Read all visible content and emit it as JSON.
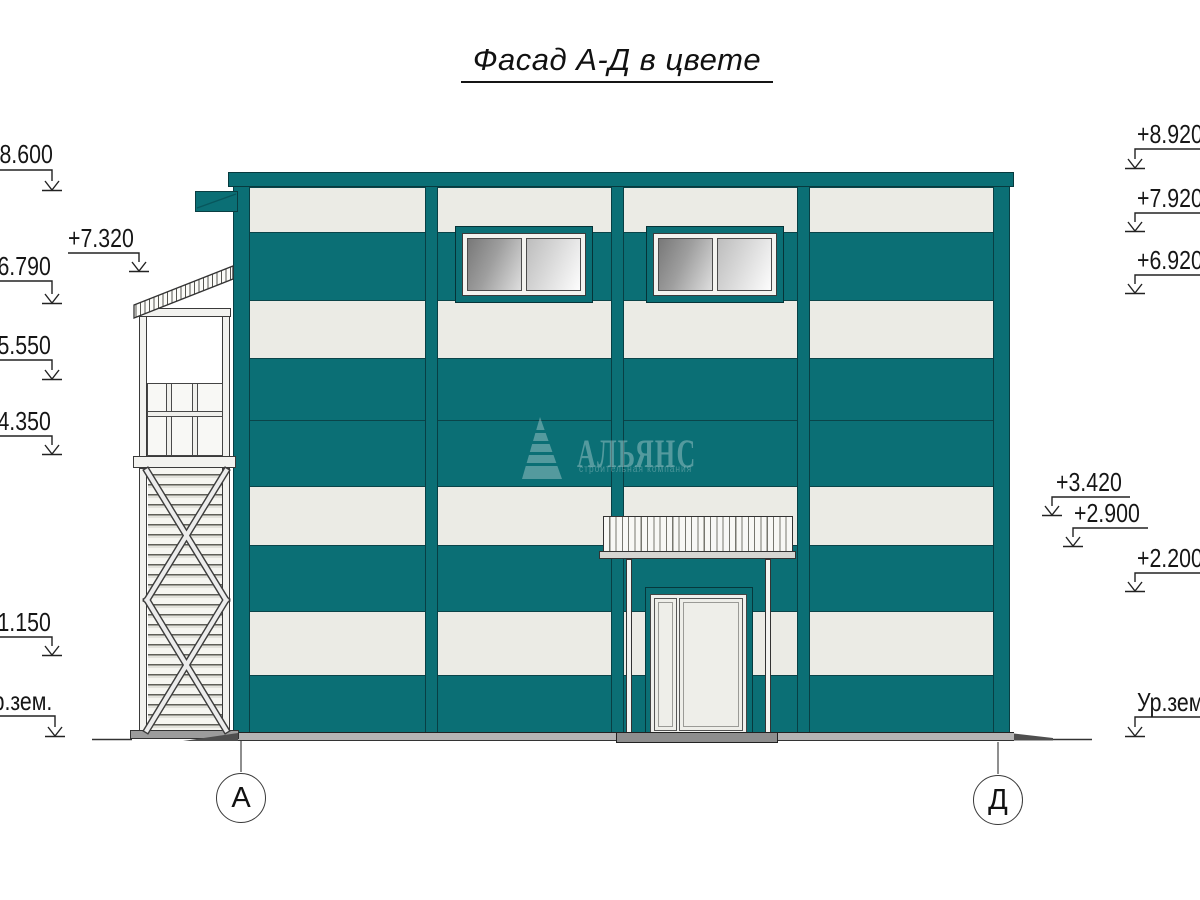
{
  "title": "Фасад А-Д в цвете",
  "elevation_markers": {
    "left": [
      "+8.600",
      "+7.320",
      "+6.790",
      "+5.550",
      "+4.350",
      "+1.150",
      "Ур.зем."
    ],
    "right": [
      "+8.920",
      "+7.920",
      "+6.920",
      "+3.420",
      "+2.900",
      "+2.200",
      "Ур.зем."
    ]
  },
  "axes": {
    "left": "А",
    "right": "Д"
  },
  "watermark": {
    "name": "АЛЬЯНС",
    "subtitle": "строительная компания"
  },
  "colors": {
    "facade_teal": "#0B6F75",
    "panel_white": "#EBEBE5",
    "glass_gray": "#9E9E9E",
    "base_gray": "#B4B4B4",
    "line_dark": "#222222"
  }
}
